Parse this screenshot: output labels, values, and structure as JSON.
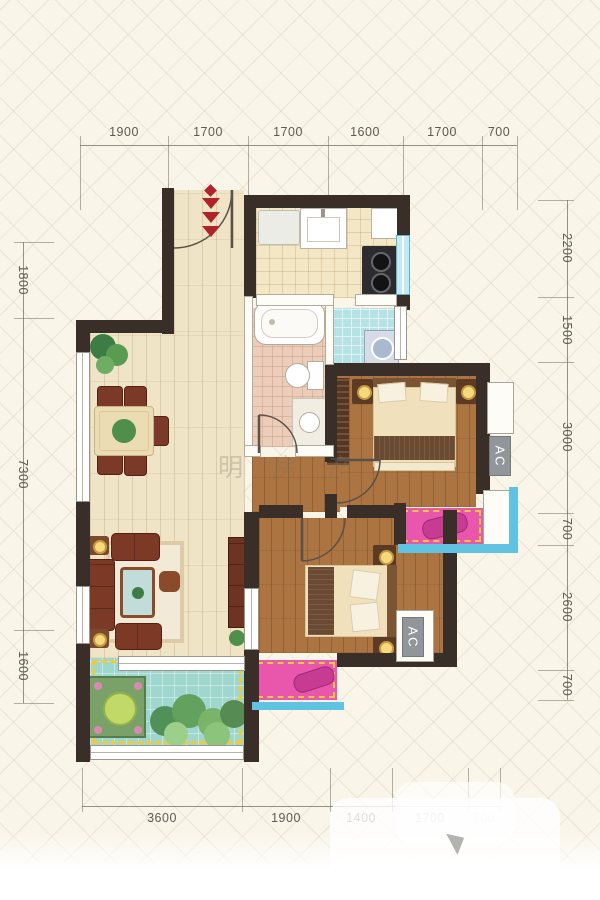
{
  "dimensions": {
    "top": [
      "1900",
      "1700",
      "1700",
      "1600",
      "1700",
      "700"
    ],
    "bottom": [
      "3600",
      "1900",
      "1400",
      "1700",
      "700"
    ],
    "left": [
      "1800",
      "7300",
      "1600"
    ],
    "right": [
      "2200",
      "1500",
      "3000",
      "700",
      "2600",
      "700"
    ]
  },
  "ac_labels": [
    "AC",
    "AC"
  ],
  "watermark": {
    "center_text": "明房产"
  },
  "colors": {
    "wall": "#3a2f28",
    "window_glass": "#c3e9f3",
    "balcony_floor": "#9fd6ce",
    "bay_window_pink": "#e857ac",
    "dashed_accent": "#f1ca3c",
    "entry_arrow_red": "#b1232b"
  }
}
